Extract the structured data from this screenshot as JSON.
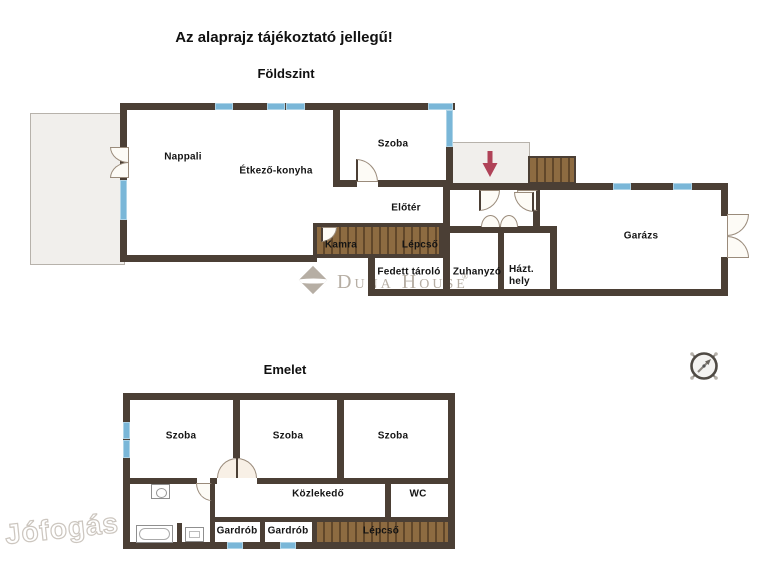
{
  "title": "Az alaprajz tájékoztató jellegű!",
  "floors": {
    "ground": {
      "heading": "Földszint",
      "rooms": {
        "nappali": "Nappali",
        "etkezo_konyha": "Étkező-konyha",
        "szoba": "Szoba",
        "eloter": "Előtér",
        "kamra": "Kamra",
        "lepcso": "Lépcső",
        "fedett_tarolo": "Fedett tároló",
        "zuhanyzo": "Zuhanyzó",
        "hazt_hely": "Házt.\nhely",
        "garazs": "Garázs"
      }
    },
    "upper": {
      "heading": "Emelet",
      "rooms": {
        "szoba1": "Szoba",
        "szoba2": "Szoba",
        "szoba3": "Szoba",
        "kozlekedo": "Közlekedő",
        "wc": "WC",
        "gardrob1": "Gardrób",
        "gardrob2": "Gardrób",
        "lepcso": "Lépcső"
      }
    }
  },
  "watermarks": {
    "brand": "Duna House",
    "registered": "®",
    "corner": "Jófogás"
  },
  "colors": {
    "wall": "#4b3f35",
    "window": "#7ab7d8",
    "wood": "#8d6b41",
    "wood-stripe": "#61472a",
    "arrow": "#b04358",
    "paving": "#f1efec",
    "door": "#fdfbf6",
    "doorline": "#9a8b7b",
    "label": "#141414",
    "watermark": "#b6aea4"
  }
}
